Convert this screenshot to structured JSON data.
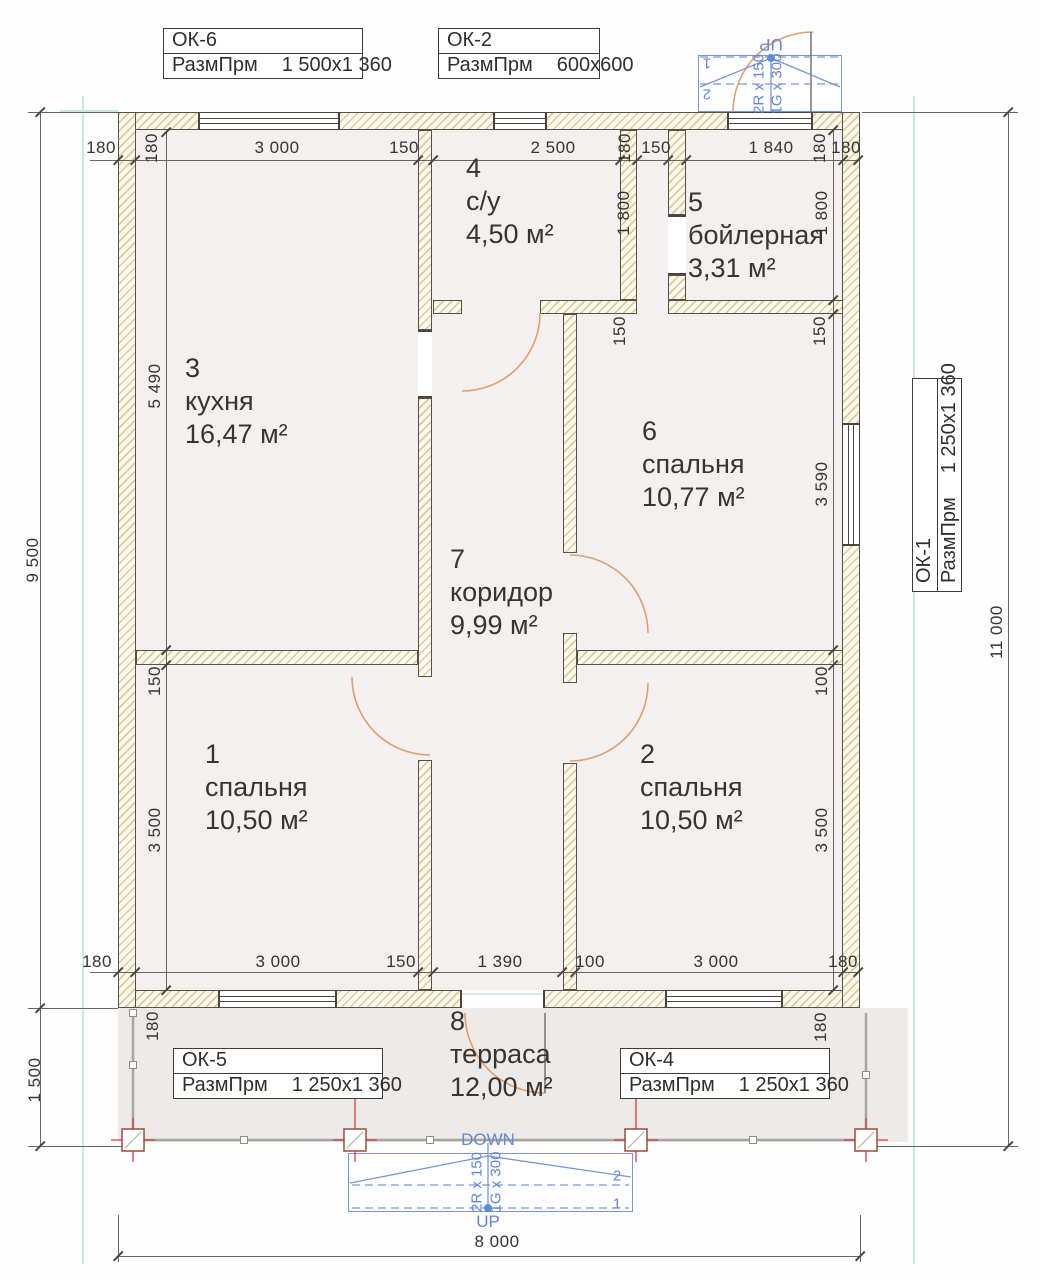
{
  "plan": {
    "rooms": [
      {
        "num": "3",
        "name": "кухня",
        "area": "16,47 м²"
      },
      {
        "num": "4",
        "name": "с/у",
        "area": "4,50 м²"
      },
      {
        "num": "5",
        "name": "бойлерная",
        "area": "3,31 м²"
      },
      {
        "num": "6",
        "name": "спальня",
        "area": "10,77 м²"
      },
      {
        "num": "7",
        "name": "коридор",
        "area": "9,99 м²"
      },
      {
        "num": "1",
        "name": "спальня",
        "area": "10,50 м²"
      },
      {
        "num": "2",
        "name": "спальня",
        "area": "10,50 м²"
      },
      {
        "num": "8",
        "name": "терраса",
        "area": "12,00 м²"
      }
    ],
    "window_tags": [
      {
        "id": "ОК-6",
        "param": "РазмПрм",
        "size": "1 500x1 360"
      },
      {
        "id": "ОК-2",
        "param": "РазмПрм",
        "size": "600x600"
      },
      {
        "id": "ОК-5",
        "param": "РазмПрм",
        "size": "1 250x1 360"
      },
      {
        "id": "ОК-4",
        "param": "РазмПрм",
        "size": "1 250x1 360"
      },
      {
        "id": "ОК-1",
        "param": "РазмПрм",
        "size": "1 250x1 360"
      }
    ],
    "stairs": {
      "down": "DOWN",
      "up": "UP",
      "risers": "2R x 150",
      "going": "1G x 300",
      "n1": "1",
      "n2": "2"
    },
    "dims": [
      "180",
      "180",
      "3 000",
      "150",
      "2 500",
      "180",
      "150",
      "1 840",
      "180",
      "180",
      "5 490",
      "1 800",
      "1 800",
      "150",
      "150",
      "3 590",
      "150",
      "3 500",
      "100",
      "3 500",
      "180",
      "3 000",
      "150",
      "1 390",
      "100",
      "3 000",
      "180",
      "180",
      "180",
      "9 500",
      "1 500",
      "11 000",
      "8 000"
    ],
    "colors": {
      "wall_hatch": "#d9cf9e",
      "room_fill": "#f3f0ef",
      "terrace_fill": "#edeae8",
      "stair_blue": "#7b96d8",
      "door_orange": "#dfa071",
      "column_red": "#cf4040",
      "axis_cyan": "#c6e8e3"
    }
  }
}
